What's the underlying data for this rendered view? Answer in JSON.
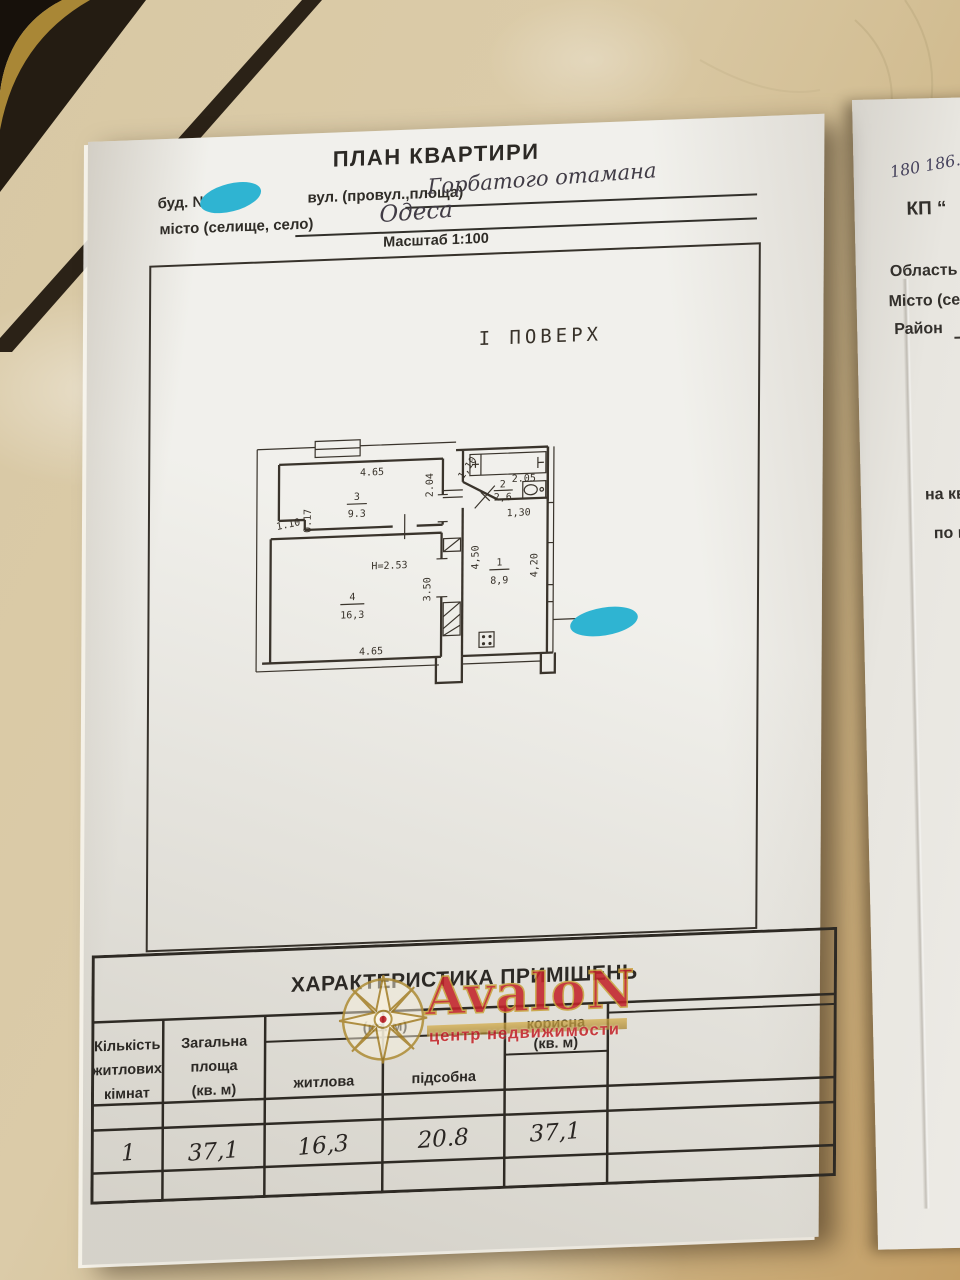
{
  "colors": {
    "cyan_marker": "#2fb4d2",
    "logo_red": "#c3242b",
    "logo_gold": "#b08f3a"
  },
  "main_doc": {
    "title": "ПЛАН КВАРТИРИ",
    "field_building": "буд. №",
    "field_street": "вул. (провул.,площа)",
    "street_value": "Горбатого отамана",
    "field_city": "місто (селище, село)",
    "city_value": "Одеса",
    "scale": "Масштаб 1:100",
    "floor_label": "І ПОВЕРХ"
  },
  "plan": {
    "rooms": {
      "r3": {
        "num": "3",
        "area": "9.3"
      },
      "r4": {
        "num": "4",
        "area": "16,3"
      },
      "r1": {
        "num": "1",
        "area": "8,9"
      },
      "r2": {
        "num": "2",
        "area": "2,6"
      }
    },
    "dims": {
      "room3_top": "4.65",
      "room3_right": "2.04",
      "room3_notch": "1.10",
      "room3_notch2": "0.17",
      "height": "Н=2.53",
      "room4_right": "3.50",
      "room4_bottom": "4.65",
      "hall_left": "4,50",
      "hall_right": "4,20",
      "hall_top": "1,30",
      "bath_top": "2.05",
      "bath_diag": "1,10"
    }
  },
  "table": {
    "title": "ХАРАКТЕРИСТИКА ПРИМІШЕНЬ",
    "col1": [
      "Кількість",
      "житлових",
      "кімнат"
    ],
    "col2": [
      "Загальна",
      "площа",
      "(кв. м)"
    ],
    "group_header": "(кв. м)",
    "col3": "житлова",
    "col4": "підсобна",
    "col5": [
      "корисна",
      "(кв. м)"
    ],
    "values": [
      "1",
      "37,1",
      "16,3",
      "20.8",
      "37,1"
    ]
  },
  "watermark": {
    "brand": "AvaloN",
    "tagline": "центр недвижимости"
  },
  "right_doc": {
    "number": "180 186.",
    "kp": "КП “",
    "region": "Область",
    "city": "Місто (се",
    "district": "Район",
    "line1": "на ква",
    "line2": "по ву"
  }
}
